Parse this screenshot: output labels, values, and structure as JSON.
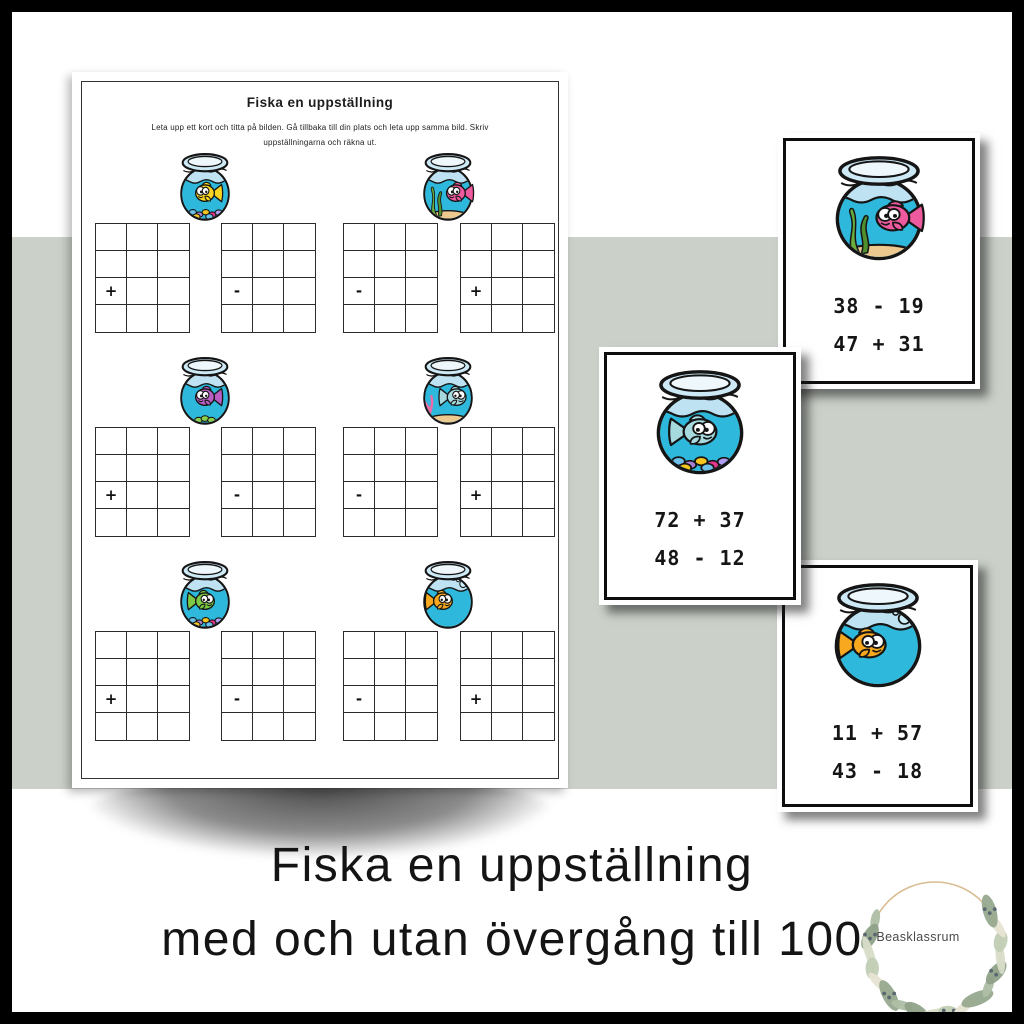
{
  "poster": {
    "worksheet": {
      "title": "Fiska en uppställning",
      "instructions": [
        "Leta upp ett kort och titta på bilden. Gå tillbaka till din plats och leta upp samma bild. Skriv",
        "uppställningarna och räkna ut."
      ],
      "sections": [
        {
          "bowl": {
            "fish": "yellow",
            "decor": "pebbles",
            "facing": "left"
          },
          "signs": [
            "+",
            "-"
          ]
        },
        {
          "bowl": {
            "fish": "pink",
            "decor": "seaweed",
            "facing": "left"
          },
          "signs": [
            "-",
            "+"
          ]
        },
        {
          "bowl": {
            "fish": "purple",
            "decor": "green-pebbles",
            "facing": "left"
          },
          "signs": [
            "+",
            "-"
          ]
        },
        {
          "bowl": {
            "fish": "teal",
            "decor": "coral",
            "facing": "right"
          },
          "signs": [
            "-",
            "+"
          ]
        },
        {
          "bowl": {
            "fish": "green",
            "decor": "pebbles",
            "facing": "right"
          },
          "signs": [
            "+",
            "-"
          ]
        },
        {
          "bowl": {
            "fish": "orange",
            "decor": "bubbles",
            "facing": "right"
          },
          "signs": [
            "-",
            "+"
          ]
        }
      ]
    },
    "cards": [
      {
        "bowl": {
          "fish": "pink",
          "decor": "seaweed",
          "facing": "left"
        },
        "problems": [
          "38 - 19",
          "47 + 31"
        ]
      },
      {
        "bowl": {
          "fish": "teal",
          "decor": "pebbles",
          "facing": "right"
        },
        "problems": [
          "72 + 37",
          "48 - 12"
        ]
      },
      {
        "bowl": {
          "fish": "orange",
          "decor": "bubbles",
          "facing": "right"
        },
        "problems": [
          "11 + 57",
          "43 - 18"
        ]
      }
    ],
    "footer": {
      "line1": "Fiska en uppställning",
      "line2": "med och utan övergång till 100",
      "logo_text": "Beasklassrum"
    }
  },
  "colors": {
    "band": "#cbd1c9",
    "water": "#2db8dc",
    "glass": "#bfe2f2",
    "rim": "#cde9f6",
    "rim_inner": "#edf7fc",
    "outline": "#151515",
    "sand": "#edc88f",
    "seaweed": "#69ab3c",
    "seaweed_dark": "#4f8f2e",
    "coral": "#ec6ba6",
    "bubble": "#cdeef8",
    "pebble_green": "#8bd04a",
    "fish": {
      "yellow": "#f8d521",
      "pink": "#ee5a9e",
      "purple": "#b95fc4",
      "teal": "#a6dade",
      "green": "#7dc844",
      "orange": "#f8a81f"
    },
    "pebbles": [
      "#ee4f9e",
      "#6cc0ea",
      "#a97fd4",
      "#f7c51e",
      "#e8368f",
      "#b39df0",
      "#ee4f9e",
      "#f7c51e",
      "#6cc0ea"
    ]
  }
}
